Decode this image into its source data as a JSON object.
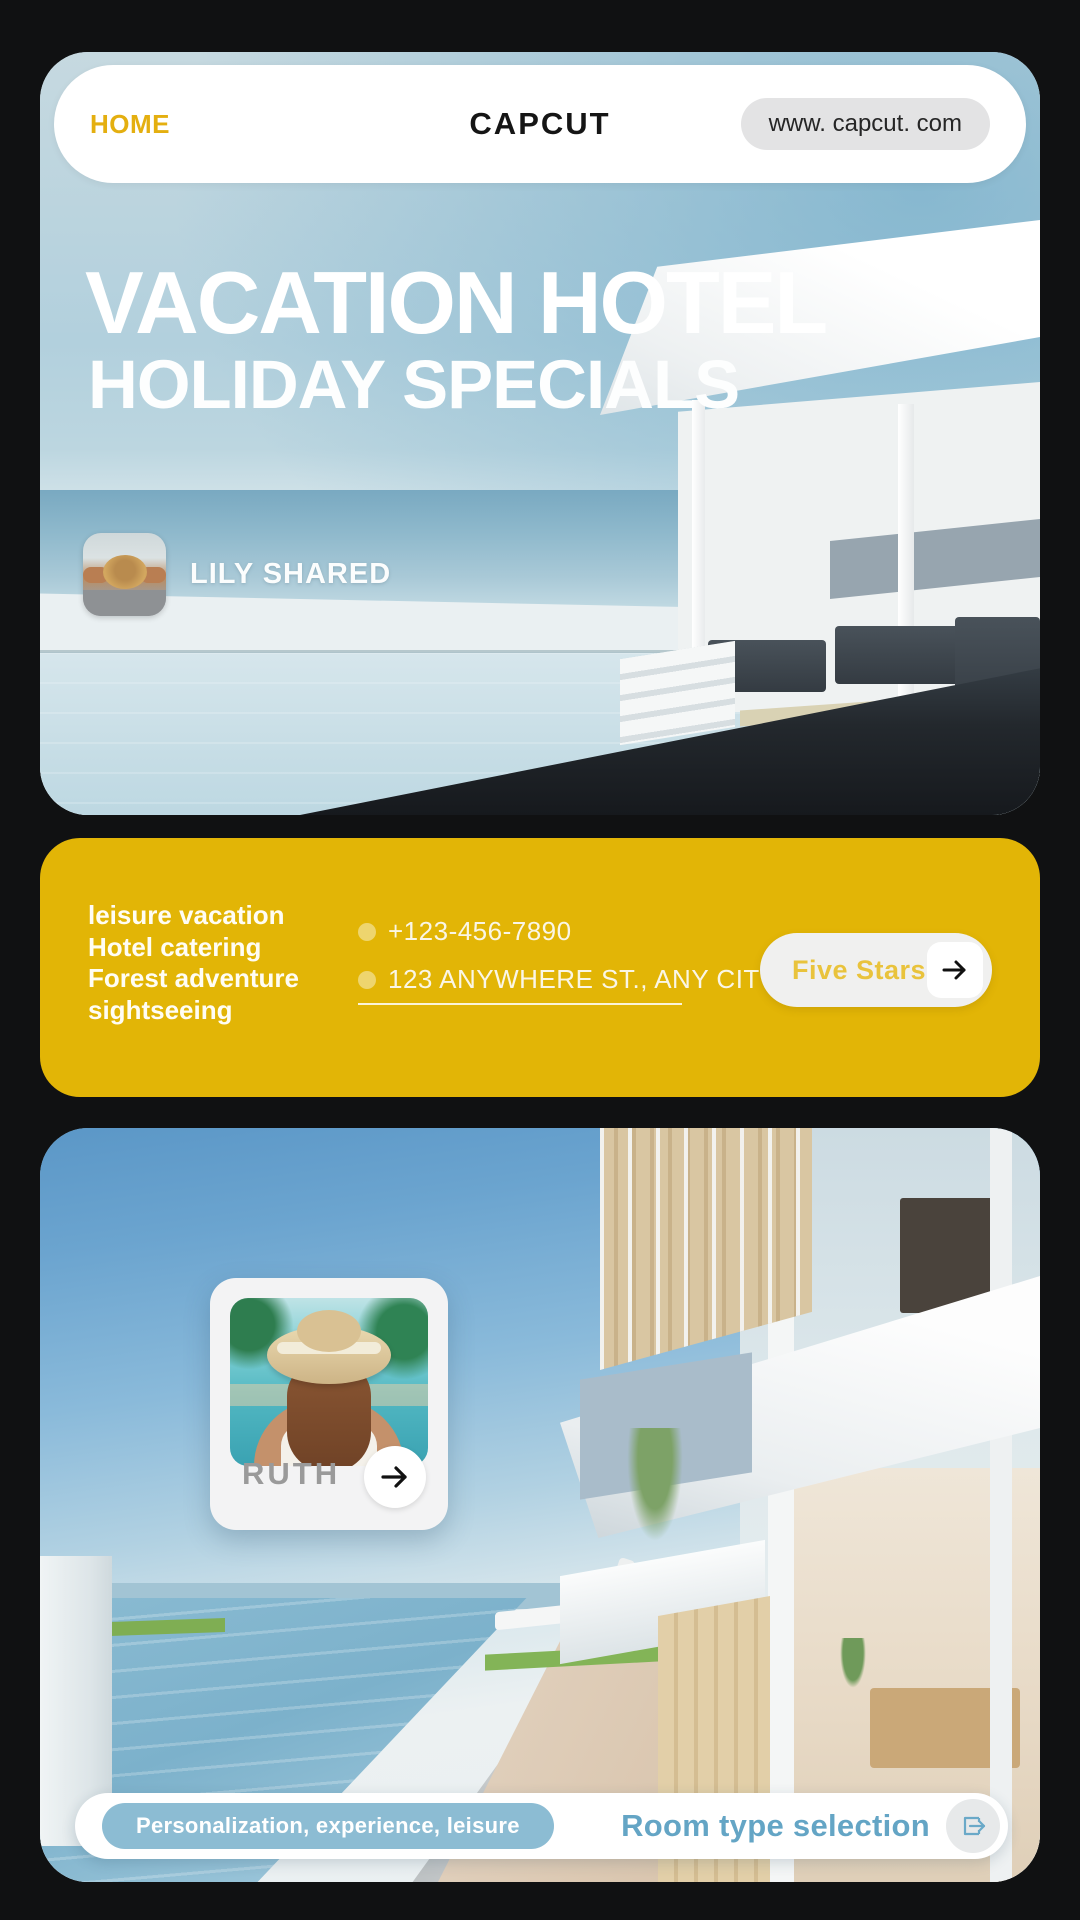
{
  "header": {
    "home": "HOME",
    "brand": "CAPCUT",
    "url": "www. capcut. com"
  },
  "hero": {
    "title_line1": "VACATION HOTEL",
    "title_line2": "HOLIDAY SPECIALS",
    "shared_by": "LILY SHARED"
  },
  "services": {
    "lines": [
      "leisure vacation",
      "Hotel catering",
      "Forest adventure",
      "sightseeing"
    ]
  },
  "contact": {
    "phone": "+123-456-7890",
    "address": "123 ANYWHERE ST., ANY CITY"
  },
  "cta": {
    "label": "Five Stars"
  },
  "profile_card": {
    "name": "RUTH"
  },
  "footer": {
    "tag": "Personalization, experience, leisure",
    "action": "Room type selection"
  },
  "colors": {
    "accent_yellow": "#e2b506",
    "home_yellow": "#e4af10",
    "cta_text_yellow": "#e9c33c",
    "footer_blue_text": "#64a5c5",
    "tag_pill_blue": "#8cbcd3",
    "background_dark": "#101112"
  }
}
